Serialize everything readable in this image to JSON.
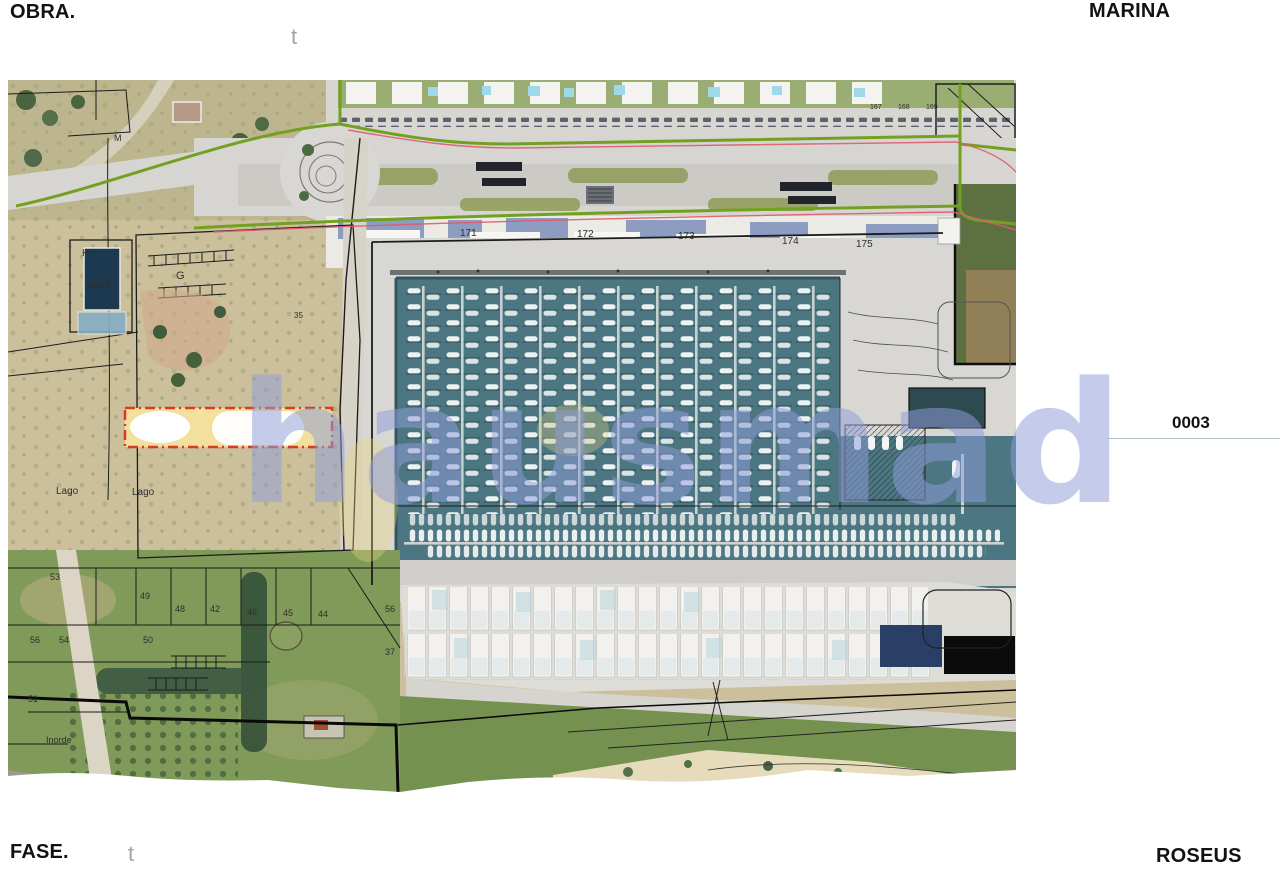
{
  "sheet": {
    "obra_label": "OBRA.",
    "obra_value": "MARINA",
    "fase_label": "FASE.",
    "fase_value": "ROSEUS",
    "sheet_number": "0003",
    "corner_mark_top": "t",
    "corner_mark_bottom": "t"
  },
  "watermark": {
    "text": "hausmad",
    "color": "#909dd8"
  },
  "map": {
    "pool_labels": [
      "171",
      "172",
      "173",
      "174",
      "175"
    ],
    "street_numbers": [
      "167",
      "168",
      "169"
    ],
    "building_label": "BEAR",
    "zone_labels": {
      "h": "H",
      "g": "G",
      "m": "M",
      "n35": "35"
    },
    "lago1": "Lago",
    "lago2": "Lago",
    "inorde": "Inorde",
    "parcels": [
      "53",
      "49",
      "48",
      "42",
      "46",
      "45",
      "44",
      "56",
      "56",
      "54",
      "50",
      "37",
      "51"
    ],
    "colors": {
      "water": "#4d7683",
      "land": "#ccc09c",
      "quay": "#d7d6d2",
      "fields": "#7e9a58",
      "green_boundary": "#74a021",
      "red_boundary": "#e05a6e",
      "parcel_fill": "#f3df9e",
      "parcel_border": "#da3b22"
    }
  }
}
